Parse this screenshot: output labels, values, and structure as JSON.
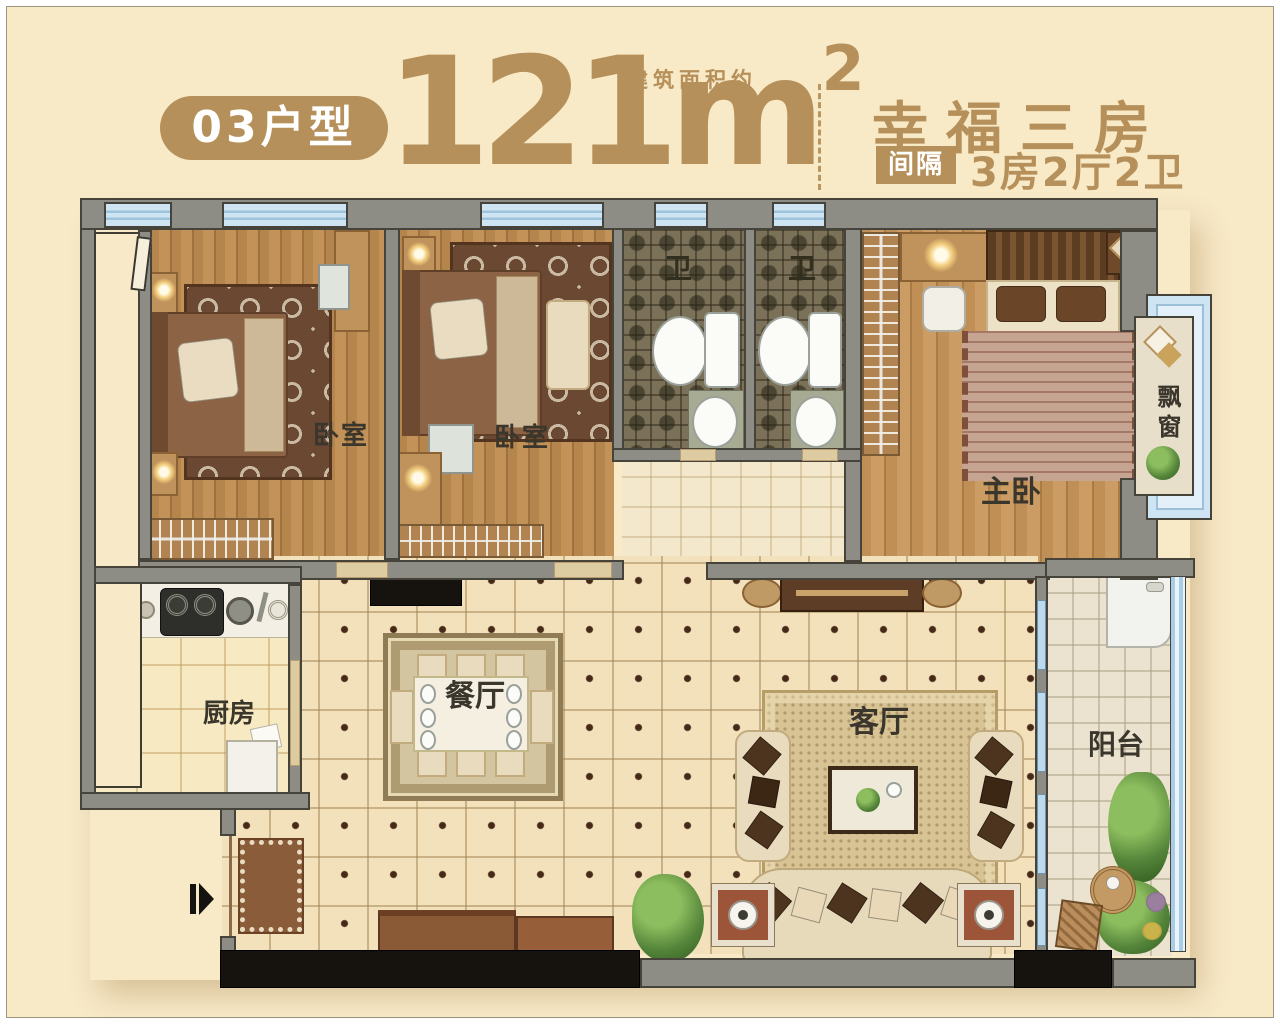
{
  "colors": {
    "accent": "#b6905a",
    "background": "#f8e9c7",
    "wall": "#8e8d85",
    "window_blue": "#cfe4f2"
  },
  "header": {
    "unit_badge": "03户型",
    "area_value": "121",
    "area_unit": "m",
    "area_sup": "2",
    "area_note": "建筑面积约",
    "title": "幸福三房",
    "divider_tag": "间隔",
    "layout_text": "3房2厅2卫"
  },
  "floorplan": {
    "rooms": [
      {
        "id": "bedroom-1",
        "label": "卧室"
      },
      {
        "id": "bedroom-2",
        "label": "卧室"
      },
      {
        "id": "bathroom-1",
        "label": "卫"
      },
      {
        "id": "bathroom-2",
        "label": "卫"
      },
      {
        "id": "master-bedroom",
        "label": "主卧"
      },
      {
        "id": "bay-window",
        "label": "飘窗"
      },
      {
        "id": "kitchen",
        "label": "厨房"
      },
      {
        "id": "dining-room",
        "label": "餐厅"
      },
      {
        "id": "living-room",
        "label": "客厅"
      },
      {
        "id": "balcony",
        "label": "阳台"
      }
    ]
  }
}
